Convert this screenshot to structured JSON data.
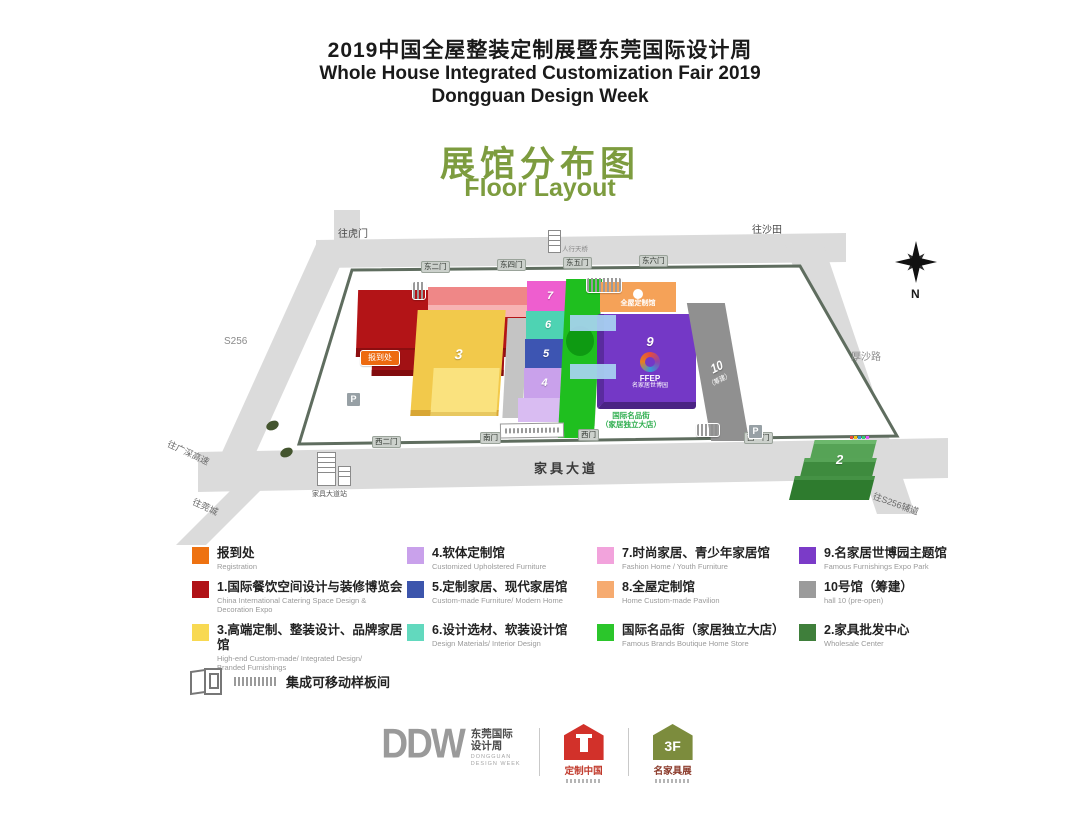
{
  "header": {
    "title_cn": "2019中国全屋整装定制展暨东莞国际设计周",
    "subtitle_en_line1": "Whole House Integrated Customization Fair 2019",
    "subtitle_en_line2": "Dongguan Design Week",
    "map_title_cn": "展馆分布图",
    "map_title_en": "Floor Layout",
    "accent_green": "#7d9c3f"
  },
  "map": {
    "road_labels": {
      "top_left": "往虎门",
      "top_right": "往沙田",
      "left": "S256",
      "right": "厚沙路",
      "bottom_left_upper": "往广深高速",
      "bottom_left_lower": "往莞城",
      "bottom_right": "往S256辅道",
      "bottom_road": "家具大道"
    },
    "gates_top": [
      "东二门",
      "东四门",
      "东五门",
      "东六门"
    ],
    "gates_bottom": [
      "西二门",
      "南门",
      "西门",
      "西一门"
    ],
    "compass_label": "N",
    "registration_badge": "报到处",
    "parking_badge": "P",
    "footbridge_label": "人行天桥",
    "bus_station_label": "家具大道站",
    "street_label_line1": "国际名品街",
    "street_label_line2": "（家居独立大店）",
    "halls": {
      "h1": {
        "num": "1",
        "color": "#b31417"
      },
      "h2": {
        "num": "2",
        "color": "#3e8b3e"
      },
      "h3": {
        "num": "3",
        "color": "#f2c94b"
      },
      "h4": {
        "num": "4",
        "color": "#c9a1eb"
      },
      "h5": {
        "num": "5",
        "color": "#3d55b2"
      },
      "h6": {
        "num": "6",
        "color": "#4ed3b3"
      },
      "h7": {
        "num": "7",
        "color": "#ee5ecf"
      },
      "h8": {
        "label": "全屋定制馆",
        "color": "#f5a258"
      },
      "h9": {
        "num": "9",
        "logo": "FFEP",
        "logo_sub": "名家居世博园",
        "color": "#7438c6"
      },
      "h10": {
        "num": "10",
        "sub": "（筹建）",
        "color": "#8f8f8f"
      }
    }
  },
  "legend": {
    "items": [
      {
        "color": "#ee7211",
        "cn": "报到处",
        "en": "Registration"
      },
      {
        "color": "#c9a1eb",
        "cn": "4.软体定制馆",
        "en": "Customized Upholstered Furniture"
      },
      {
        "color": "#f2a3dc",
        "cn": "7.时尚家居、青少年家居馆",
        "en": "Fashion Home / Youth Furniture"
      },
      {
        "color": "#7b3bc8",
        "cn": "9.名家居世博园主题馆",
        "en": "Famous Furnishings Expo Park"
      },
      {
        "color": "#b01217",
        "cn": "1.国际餐饮空间设计与装修博览会",
        "en": "China International Catering Space Design & Decoration Expo"
      },
      {
        "color": "#3c55ac",
        "cn": "5.定制家居、现代家居馆",
        "en": "Custom-made Furniture/ Modern Home"
      },
      {
        "color": "#f6ab70",
        "cn": "8.全屋定制馆",
        "en": "Home Custom-made Pavilion"
      },
      {
        "color": "#9b9b9b",
        "cn": "10号馆（筹建）",
        "en": "hall 10 (pre-open)"
      },
      {
        "color": "#f8d952",
        "cn": "3.高端定制、整装设计、品牌家居馆",
        "en": "High-end Custom-made/ Integrated Design/ Branded Furnishings"
      },
      {
        "color": "#62d9be",
        "cn": "6.设计选材、软装设计馆",
        "en": "Design Materials/ Interior Design"
      },
      {
        "color": "#2bc62b",
        "cn": "国际名品街（家居独立大店）",
        "en": "Famous Brands Boutique Home Store"
      },
      {
        "color": "#3f7f3b",
        "cn": "2.家具批发中心",
        "en": "Wholesale Center"
      }
    ],
    "extra_label": "集成可移动样板间"
  },
  "footer": {
    "ddw_mark": "DDW",
    "ddw_cn_line1": "东莞国际",
    "ddw_cn_line2": "设计周",
    "ddw_en_line1": "DONGGUAN",
    "ddw_en_line2": "DESIGN WEEK",
    "logo_home_cn": "定制中国",
    "logo_3f_mark": "3F",
    "logo_3f_cn": "名家具展"
  }
}
